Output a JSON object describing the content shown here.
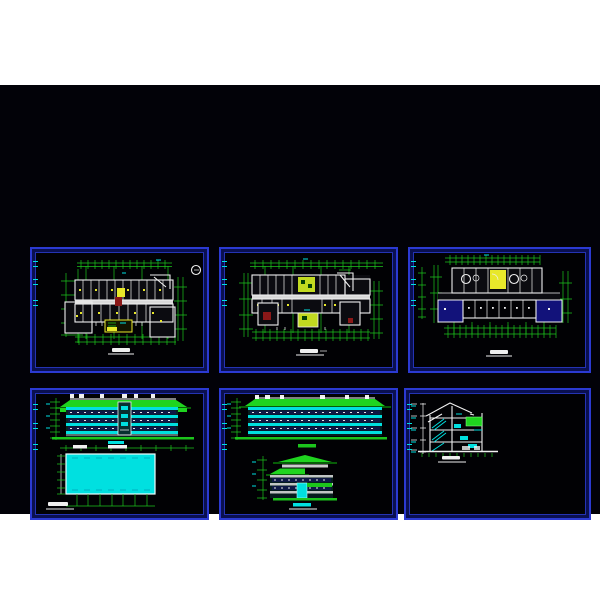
{
  "app": {
    "name": "cad-drawing-sheet",
    "description": "CAD paper space with six drawing viewports on black workspace, letterboxed on white"
  },
  "colors": {
    "page_background": "#ffffff",
    "workspace_background": "#020208",
    "viewport_border": "#2b3ad2",
    "viewport_border_dark": "#0a1050",
    "viewport_inner_line": "#2433b4",
    "grid_green": "#1cc41c",
    "roof_green": "#1fd41f",
    "wall_white": "#f0f0f0",
    "cyan": "#00e0e0",
    "yellow": "#e8e82a",
    "yellow_green": "#c2da20",
    "dark_red": "#8a1818",
    "navy_room": "#12127a"
  },
  "panels": [
    {
      "id": "viewport-floor-plan-1",
      "label": "floor-plan-1",
      "position": "top-left",
      "features": [
        "column-grid",
        "room-layout",
        "yellow-stair-highlight",
        "north-circle-symbol",
        "title-mark"
      ]
    },
    {
      "id": "viewport-floor-plan-2",
      "label": "floor-plan-2",
      "position": "top-center",
      "features": [
        "column-grid",
        "room-layout",
        "yellow-green-stair-cores",
        "red-room-fills",
        "title-mark"
      ]
    },
    {
      "id": "viewport-floor-plan-3",
      "label": "floor-plan-3",
      "position": "top-right",
      "features": [
        "column-grid",
        "room-layout",
        "yellow-room",
        "navy-room-fills",
        "circle-fixtures",
        "title-mark"
      ]
    },
    {
      "id": "viewport-elevations-front",
      "label": "front-and-rear-elevation",
      "position": "bottom-left",
      "features": [
        "green-roof-elevation",
        "cyan-wall-bands",
        "solid-cyan-rear-elevation",
        "dimension-lines",
        "title-mark"
      ]
    },
    {
      "id": "viewport-elevations-side",
      "label": "side-elevations",
      "position": "bottom-center",
      "features": [
        "green-roof-elevation",
        "cyan-wall-bands",
        "two-stacked-elevations",
        "dimension-lines",
        "title-mark"
      ]
    },
    {
      "id": "viewport-section",
      "label": "building-section",
      "position": "bottom-right",
      "features": [
        "section-cut",
        "cyan-stairs",
        "green-block",
        "level-marks",
        "title-mark"
      ]
    }
  ],
  "viewport_label_marks_per_panel": 3
}
